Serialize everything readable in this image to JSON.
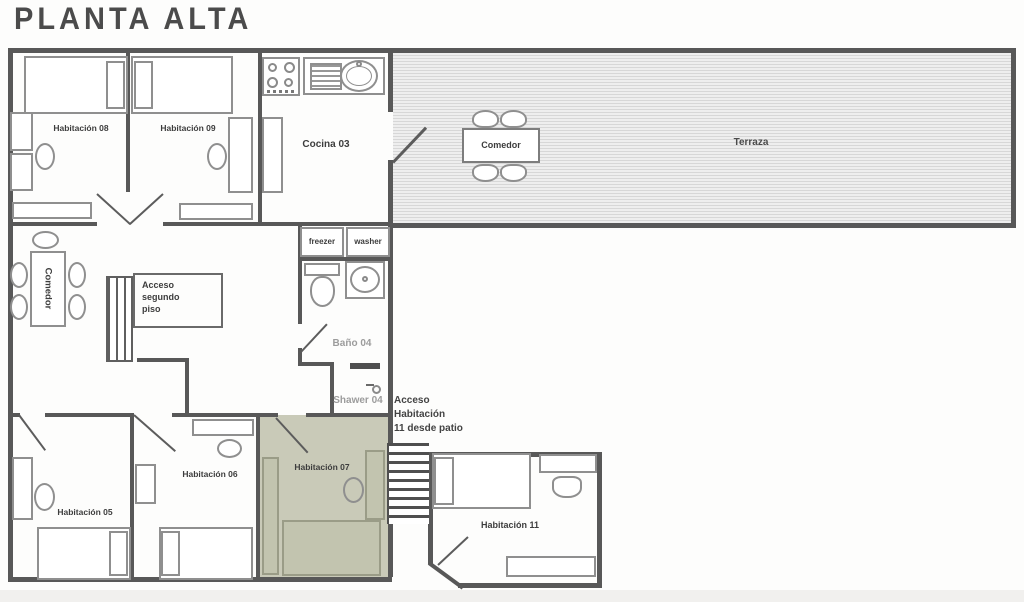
{
  "title": "PLANTA ALTA",
  "colors": {
    "highlight_room": "#c9cab8",
    "wall": "#585858",
    "muted_label": "#9c9c9c",
    "deck_stripe": "#d7d7d7"
  },
  "rooms": {
    "habitacion_08": {
      "label": "Habitación 08"
    },
    "habitacion_09": {
      "label": "Habitación 09"
    },
    "cocina_03": {
      "label": "Cocina 03"
    },
    "terraza": {
      "label": "Terraza"
    },
    "comedor_terraza": {
      "label": "Comedor"
    },
    "comedor_interior": {
      "label": "Comedor"
    },
    "bano_04": {
      "label": "Baño 04"
    },
    "shower_04": {
      "label": "Shawer 04"
    },
    "habitacion_05": {
      "label": "Habitación 05"
    },
    "habitacion_06": {
      "label": "Habitación 06"
    },
    "habitacion_07": {
      "label": "Habitación 07",
      "highlighted": true
    },
    "habitacion_11": {
      "label": "Habitación 11"
    }
  },
  "fixtures": {
    "freezer": {
      "label": "freezer"
    },
    "washer": {
      "label": "washer"
    }
  },
  "annotations": {
    "acceso_segundo_piso": {
      "lines": [
        "Acceso",
        "segundo",
        "piso"
      ]
    },
    "acceso_habitacion_11": {
      "lines": [
        "Acceso",
        "Habitación",
        "11 desde patio"
      ]
    }
  }
}
